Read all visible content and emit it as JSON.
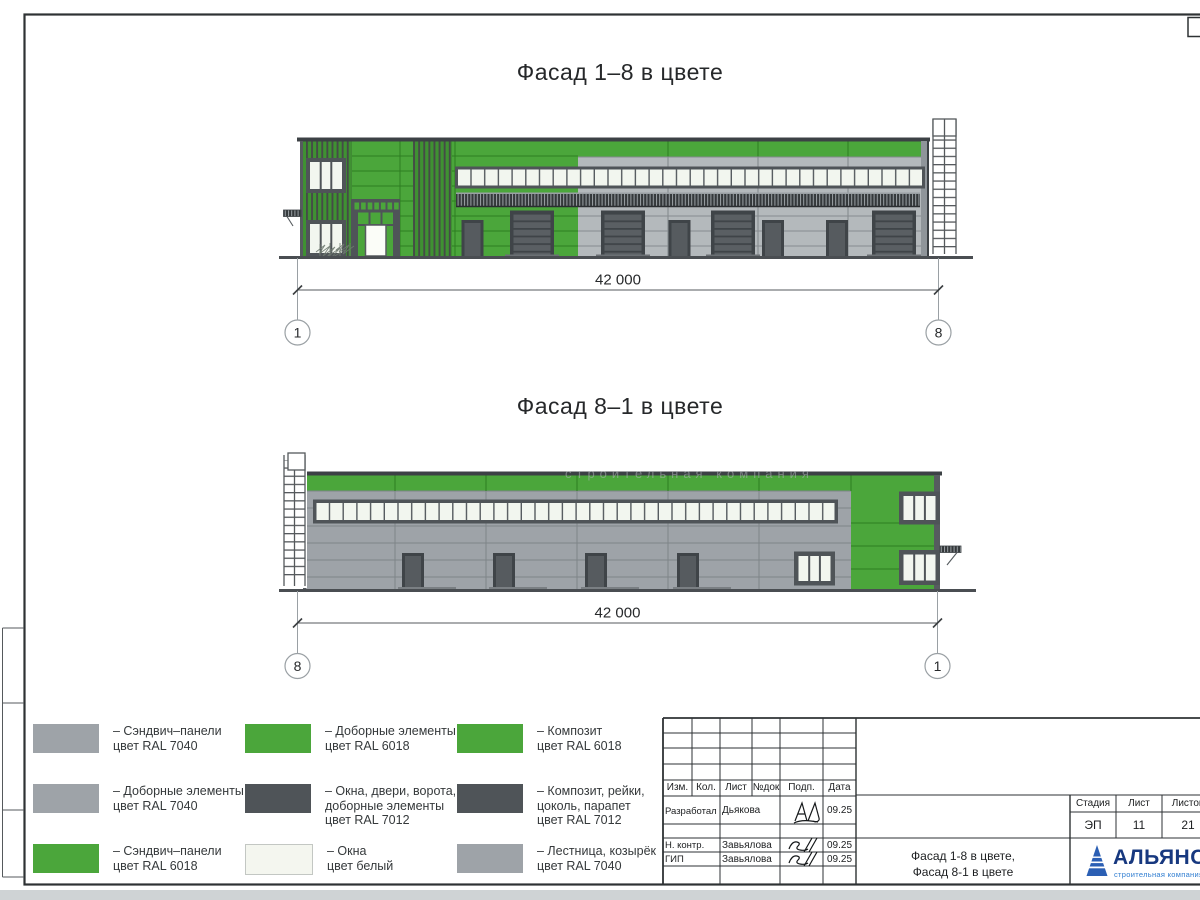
{
  "palette": {
    "ral7040": "#9EA3A8",
    "ral7040_light": "#B4B9BC",
    "ral6018": "#4BA63B",
    "ral6018_dark": "#2E7D22",
    "ral7012": "#4F5458",
    "ral7012_dark": "#3C4145",
    "window_white": "#F2F6EF",
    "logo_blue": "#17387f",
    "logo_light_blue": "#2F7DD1"
  },
  "facade_top": {
    "title": "Фасад 1–8 в цвете",
    "dimension": "42 000",
    "axis_left": "1",
    "axis_right": "8"
  },
  "facade_bottom": {
    "title": "Фасад 8–1 в цвете",
    "dimension": "42 000",
    "axis_left": "8",
    "axis_right": "1"
  },
  "watermark": "строительная компания",
  "legend": {
    "items": [
      {
        "lines": [
          "– Сэндвич–панели",
          "цвет RAL 7040"
        ],
        "color": "#9EA3A8"
      },
      {
        "lines": [
          "– Доборные элементы",
          "цвет RAL 7040"
        ],
        "color": "#9EA3A8"
      },
      {
        "lines": [
          "– Сэндвич–панели",
          "цвет RAL 6018"
        ],
        "color": "#4BA63B"
      },
      {
        "lines": [
          "– Доборные элементы",
          "цвет RAL 6018"
        ],
        "color": "#4BA63B"
      },
      {
        "lines": [
          "– Окна, двери, ворота,",
          "доборные элементы",
          "цвет RAL 7012"
        ],
        "color": "#4F5458"
      },
      {
        "lines": [
          "– Окна",
          "цвет белый"
        ],
        "color": "#F4F6EF"
      },
      {
        "lines": [
          "– Композит",
          "цвет RAL 6018"
        ],
        "color": "#4BA63B"
      },
      {
        "lines": [
          "– Композит, рейки,",
          "цоколь, парапет",
          "цвет RAL 7012"
        ],
        "color": "#4F5458"
      },
      {
        "lines": [
          "– Лестница, козырёк",
          "цвет RAL 7040"
        ],
        "color": "#9EA3A8"
      }
    ]
  },
  "title_block": {
    "header_cols": [
      "Изм.",
      "Кол.",
      "Лист",
      "№док",
      "Подп.",
      "Дата"
    ],
    "rows": [
      {
        "role": "Разработал",
        "name": "Дьякова",
        "date": "09.25"
      },
      {
        "role": "Н. контр.",
        "name": "Завьялова",
        "date": "09.25"
      },
      {
        "role": "ГИП",
        "name": "Завьялова",
        "date": "09.25"
      }
    ],
    "doc_title_line1": "Фасад 1-8 в цвете,",
    "doc_title_line2": "Фасад 8-1 в цвете",
    "stage_label": "Стадия",
    "sheet_label": "Лист",
    "sheets_label": "Листов",
    "stage_value": "ЭП",
    "sheet_value": "11",
    "sheets_value": "21",
    "company_name": "АЛЬЯНС",
    "company_sub": "строительная компания"
  }
}
